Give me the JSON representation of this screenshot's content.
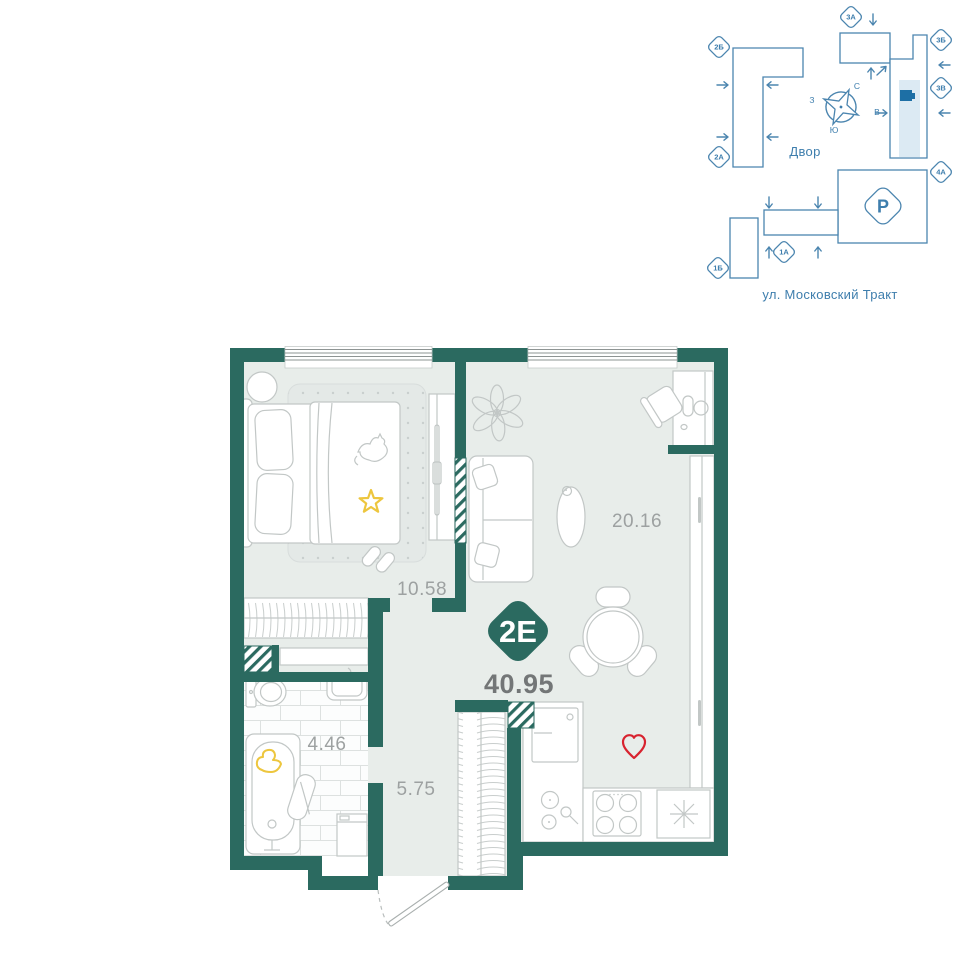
{
  "site_plan": {
    "courtyard_label": "Двор",
    "street_label": "ул. Московский Тракт",
    "parking_label": "P",
    "compass": {
      "north": "С",
      "east": "В",
      "south": "Ю",
      "west": "З"
    },
    "building_labels": {
      "b2b": "2Б",
      "b2a": "2А",
      "b3a": "3А",
      "b3b": "3Б",
      "b3v": "3В",
      "b4a": "4А",
      "b1b": "1Б",
      "b1a": "1А"
    },
    "colors": {
      "outline": "#4B85AF",
      "text": "#3E7EAD",
      "highlight": "#DCEAF3",
      "marker": "#1D6FA5"
    }
  },
  "floor_plan": {
    "unit_label": "2Е",
    "total_area": "40.95",
    "rooms": {
      "living_kitchen": {
        "area": "20.16"
      },
      "bedroom": {
        "area": "10.58"
      },
      "bathroom": {
        "area": "4.46"
      },
      "hallway": {
        "area": "5.75"
      }
    },
    "colors": {
      "wall": "#2B6A60",
      "floor": "#E8EDEA",
      "furniture_line": "#C2C7C6",
      "accent_yellow": "#EDC63E",
      "accent_red": "#D8232F",
      "room_label": "#9DA1A1",
      "total_label": "#737677"
    }
  }
}
